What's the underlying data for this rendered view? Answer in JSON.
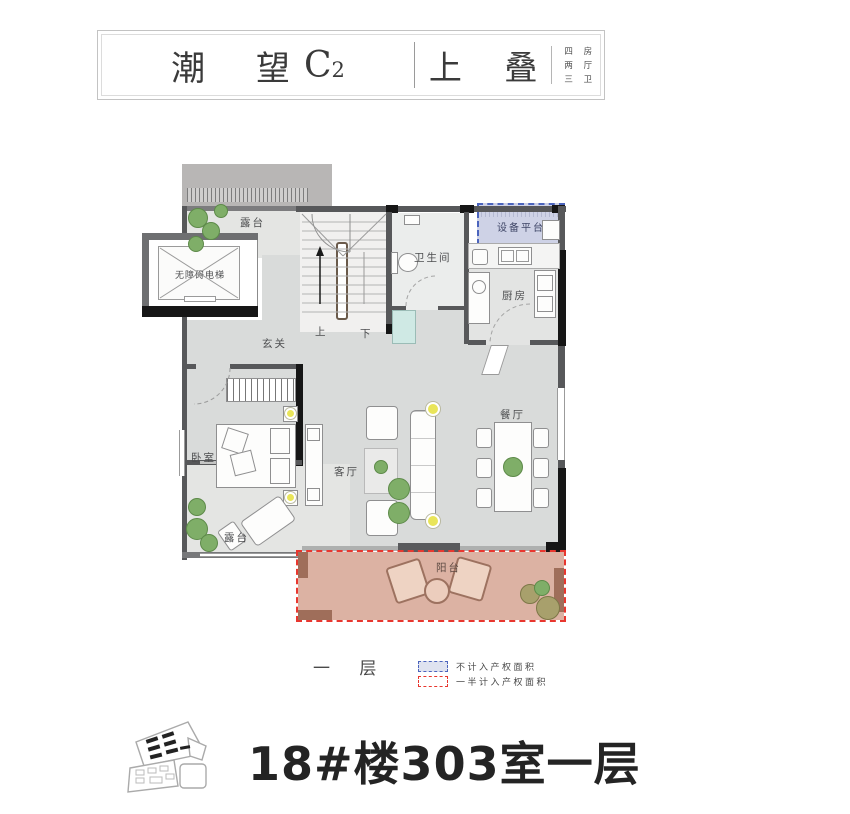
{
  "header": {
    "title": "潮 望",
    "title_code": "C",
    "title_code_sub": "2",
    "type_label": "上 叠",
    "specs": [
      "四 房",
      "两 厅",
      "三 卫"
    ]
  },
  "plan": {
    "labels": {
      "terrace_top": "露台",
      "elevator": "无障碍电梯",
      "up": "上",
      "down": "下",
      "foyer": "玄关",
      "bathroom": "卫生间",
      "equipment_platform": "设备平台",
      "kitchen": "厨房",
      "bedroom": "卧室",
      "living_room": "客厅",
      "dining_room": "餐厅",
      "terrace_bottom": "露台",
      "balcony": "阳台"
    },
    "floor_label": "一 层"
  },
  "legend": {
    "items": [
      {
        "label": "不计入产权面积",
        "style": "blue-dashed",
        "color": "#4b64bd"
      },
      {
        "label": "一半计入产权面积",
        "style": "red-dashed",
        "color": "#e8372f"
      }
    ]
  },
  "footer": {
    "title": "18#楼303室一层"
  },
  "colors": {
    "floor": "#d9dbda",
    "terrace_floor": "#e4e5e3",
    "wall_dark": "#57585a",
    "wall_black": "#161616",
    "roof": "#b8b6b5",
    "balcony_fill": "#dcb2a3",
    "balcony_accent": "#9d7260",
    "equipment_fill": "#ced2e6",
    "equipment_border": "#4b64bd",
    "legend_red": "#e8372f",
    "plant_green": "#7fae68",
    "lamp_yellow": "#e9e559",
    "shower_teal": "#cfe9e4"
  }
}
